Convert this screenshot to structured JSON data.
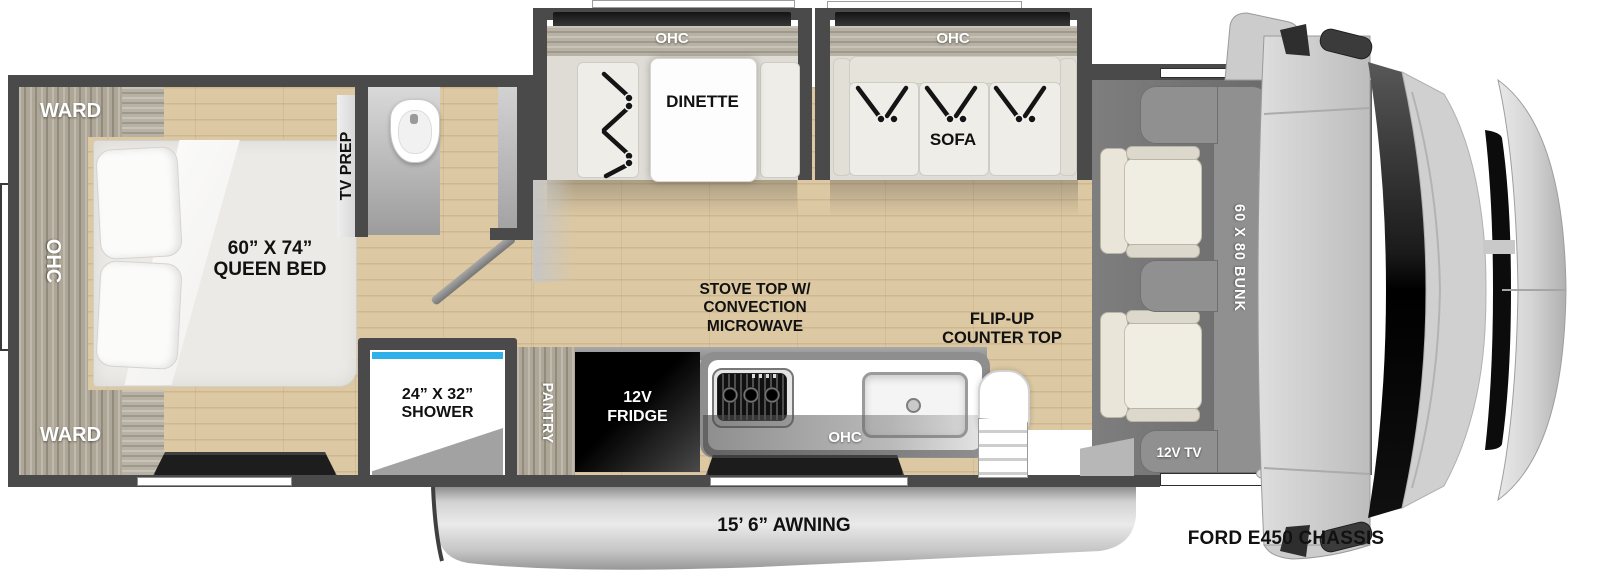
{
  "colors": {
    "wall": "#4a4a4a",
    "wood_floor": "#dcc8a2",
    "cabinet_wood": "#aea797",
    "white_furniture": "#efede7",
    "window_dark": "#1d1d1d",
    "bunk_gray": "#8f8f8f",
    "shower_glass": "#2fb0e8",
    "cab_body": "#cecece",
    "fridge_black": "#0a0a0a",
    "awning_gray": "#c9c9c9"
  },
  "bedroom": {
    "ward_top": "WARD",
    "ward_bottom": "WARD",
    "ohc": "OHC",
    "queen_bed": "60” X 74”\nQUEEN BED",
    "tv_prep": "TV PREP"
  },
  "shower": {
    "label": "24” X 32”\nSHOWER"
  },
  "kitchen": {
    "pantry": "PANTRY",
    "fridge": "12V\nFRIDGE",
    "stove": "STOVE TOP W/\nCONVECTION\nMICROWAVE",
    "ohc": "OHC",
    "flip_up_counter": "FLIP-UP\nCOUNTER TOP"
  },
  "dinette": {
    "ohc": "OHC",
    "label": "DINETTE"
  },
  "sofa": {
    "ohc": "OHC",
    "label": "SOFA"
  },
  "cab": {
    "bunk": "60 X 80 BUNK",
    "tv": "12V TV"
  },
  "awning": {
    "label": "15’ 6” AWNING"
  },
  "chassis": {
    "label": "FORD E450 CHASSIS"
  }
}
